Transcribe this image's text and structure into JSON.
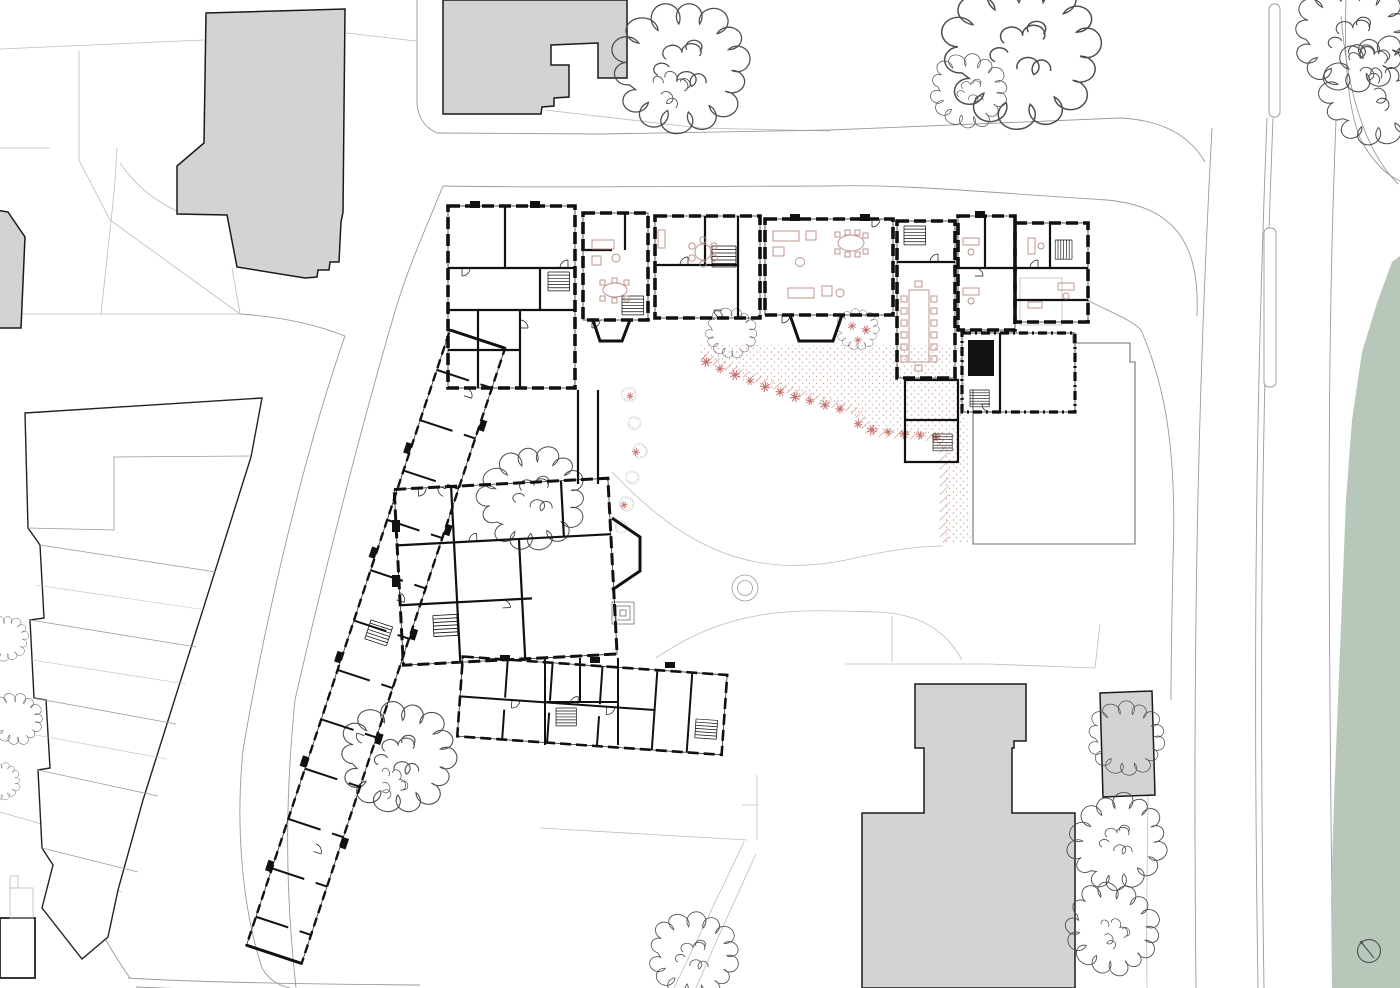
{
  "document": {
    "type": "architectural-site-plan",
    "description": "Black-and-white measured site plan with ground-floor plan of a large building complex, grey context buildings, street kerb lines, sketched trees, red furniture and planting, and a green riverside strip on the right edge",
    "north_arrow": "circle-with-needle"
  },
  "colors": {
    "paper": "#ffffff",
    "wall": "#111111",
    "context_fill": "#d3d3d3",
    "context_stroke": "#1a1a1a",
    "outline_dark": "#222222",
    "parcel": "#bcbcbc",
    "kerb": "#9a9a9a",
    "boundary": "#707070",
    "tree": "#4d4d4d",
    "green": "#b7c8bb",
    "furniture": "#b98b85",
    "plant": "#c4716b",
    "hatch": "#d59b92",
    "stipple": "#cfa99f",
    "north_arrow": "#555555",
    "white": "#ffffff"
  }
}
